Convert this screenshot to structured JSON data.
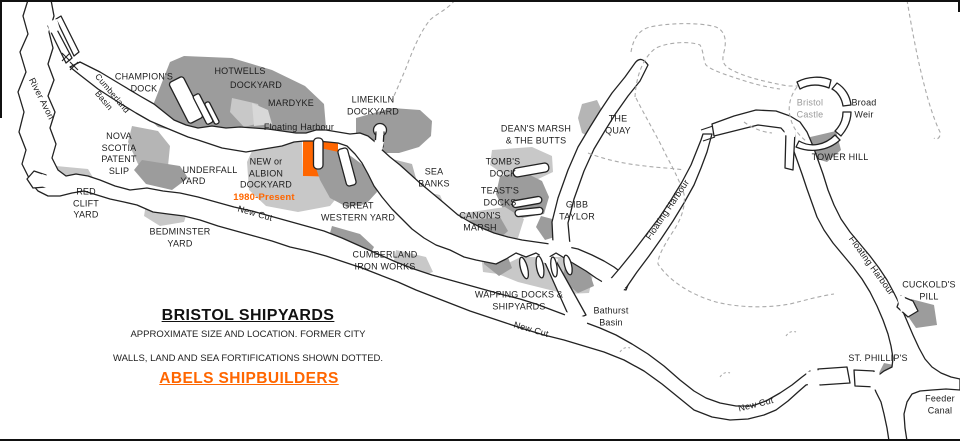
{
  "map": {
    "title": "BRISTOL SHIPYARDS",
    "subtitle_line1": "APPROXIMATE SIZE AND LOCATION. FORMER CITY",
    "subtitle_line2": "WALLS, LAND AND SEA FORTIFICATIONS SHOWN DOTTED.",
    "credit": "ABELS SHIPBUILDERS",
    "colors": {
      "orange": "#ff6600",
      "dark": "#9c9c9c",
      "mid": "#b5b5b5",
      "light": "#c8c8c8",
      "outline": "#222222",
      "dashed": "#aaaaaa",
      "muted": "#9a9a9a"
    },
    "labels": [
      {
        "id": "river-avon",
        "lines": [
          "River Avon"
        ],
        "x": 41,
        "y": 99,
        "rot": 63
      },
      {
        "id": "cumberland-basin",
        "lines": [
          "Cumberland",
          "Basin"
        ],
        "x": 108,
        "y": 97,
        "rot": 50,
        "fs": 8.5
      },
      {
        "id": "champions-dock",
        "lines": [
          "CHAMPION'S",
          "DOCK"
        ],
        "x": 144,
        "y": 83
      },
      {
        "id": "hotwells-1",
        "lines": [
          "HOTWELLS"
        ],
        "x": 240,
        "y": 72
      },
      {
        "id": "hotwells-2",
        "lines": [
          "DOCKYARD"
        ],
        "x": 256,
        "y": 86
      },
      {
        "id": "mardyke",
        "lines": [
          "MARDYKE"
        ],
        "x": 291,
        "y": 104
      },
      {
        "id": "limekiln-dockyard",
        "lines": [
          "LIMEKILN",
          "DOCKYARD"
        ],
        "x": 373,
        "y": 106
      },
      {
        "id": "floating-harbour-1",
        "lines": [
          "Floating Harbour"
        ],
        "x": 299,
        "y": 128
      },
      {
        "id": "nova-scotia",
        "lines": [
          "NOVA",
          "SCOTIA",
          "PATENT",
          "SLIP"
        ],
        "x": 119,
        "y": 154
      },
      {
        "id": "underfall-1",
        "lines": [
          "UNDERFALL"
        ],
        "x": 210,
        "y": 171
      },
      {
        "id": "underfall-2",
        "lines": [
          "YARD"
        ],
        "x": 193,
        "y": 182
      },
      {
        "id": "albion-dockyard",
        "lines": [
          "NEW or",
          "ALBION",
          "DOCKYARD"
        ],
        "x": 266,
        "y": 174
      },
      {
        "id": "albion-period",
        "lines": [
          "1980-Present"
        ],
        "x": 264,
        "y": 198,
        "cls": "orange"
      },
      {
        "id": "red-clift-yard",
        "lines": [
          "RED",
          "CLIFT",
          "YARD"
        ],
        "x": 86,
        "y": 204
      },
      {
        "id": "bedminster-yard",
        "lines": [
          "BEDMINSTER",
          "YARD"
        ],
        "x": 180,
        "y": 238
      },
      {
        "id": "new-cut-1",
        "lines": [
          "New Cut"
        ],
        "x": 255,
        "y": 214,
        "rot": 16
      },
      {
        "id": "great-western-yard",
        "lines": [
          "GREAT",
          "WESTERN YARD"
        ],
        "x": 358,
        "y": 212
      },
      {
        "id": "sea-banks",
        "lines": [
          "SEA",
          "BANKS"
        ],
        "x": 434,
        "y": 178
      },
      {
        "id": "cumberland-iron-works",
        "lines": [
          "CUMBERLAND",
          "IRON WORKS"
        ],
        "x": 385,
        "y": 261
      },
      {
        "id": "wapping-docks",
        "lines": [
          "WAPPING DOCKS &",
          "SHIPYARDS"
        ],
        "x": 519,
        "y": 301
      },
      {
        "id": "canons-marsh",
        "lines": [
          "CANON'S",
          "MARSH"
        ],
        "x": 480,
        "y": 222
      },
      {
        "id": "teasts-docks",
        "lines": [
          "TEAST'S",
          "DOCKS"
        ],
        "x": 500,
        "y": 197
      },
      {
        "id": "tombs-dock",
        "lines": [
          "TOMB'S",
          "DOCK"
        ],
        "x": 503,
        "y": 168
      },
      {
        "id": "deans-marsh",
        "lines": [
          "DEAN'S MARSH",
          "& THE BUTTS"
        ],
        "x": 536,
        "y": 135
      },
      {
        "id": "the-quay",
        "lines": [
          "THE",
          "QUAY"
        ],
        "x": 618,
        "y": 125
      },
      {
        "id": "gibb-taylor",
        "lines": [
          "GIBB",
          "TAYLOR"
        ],
        "x": 577,
        "y": 211
      },
      {
        "id": "bathurst-basin",
        "lines": [
          "Bathurst",
          "Basin"
        ],
        "x": 611,
        "y": 317
      },
      {
        "id": "new-cut-2",
        "lines": [
          "New Cut"
        ],
        "x": 531,
        "y": 330,
        "rot": 16
      },
      {
        "id": "floating-harbour-2",
        "lines": [
          "Floating Harbour"
        ],
        "x": 668,
        "y": 210,
        "rot": -56
      },
      {
        "id": "bristol-castle",
        "lines": [
          "Bristol",
          "Castle"
        ],
        "x": 810,
        "y": 109,
        "cls": "gray"
      },
      {
        "id": "broad-weir",
        "lines": [
          "Broad",
          "Weir"
        ],
        "x": 864,
        "y": 109
      },
      {
        "id": "tower-hill",
        "lines": [
          "TOWER HILL"
        ],
        "x": 840,
        "y": 158
      },
      {
        "id": "floating-harbour-3",
        "lines": [
          "Floating Harbour"
        ],
        "x": 871,
        "y": 266,
        "rot": 54
      },
      {
        "id": "cuckolds-pill",
        "lines": [
          "CUCKOLD'S",
          "PILL"
        ],
        "x": 929,
        "y": 291
      },
      {
        "id": "st-phillips",
        "lines": [
          "ST. PHILLIP'S"
        ],
        "x": 878,
        "y": 359
      },
      {
        "id": "new-cut-3",
        "lines": [
          "New Cut"
        ],
        "x": 756,
        "y": 405,
        "rot": -14
      },
      {
        "id": "feeder-canal",
        "lines": [
          "Feeder",
          "Canal"
        ],
        "x": 940,
        "y": 405
      }
    ]
  }
}
